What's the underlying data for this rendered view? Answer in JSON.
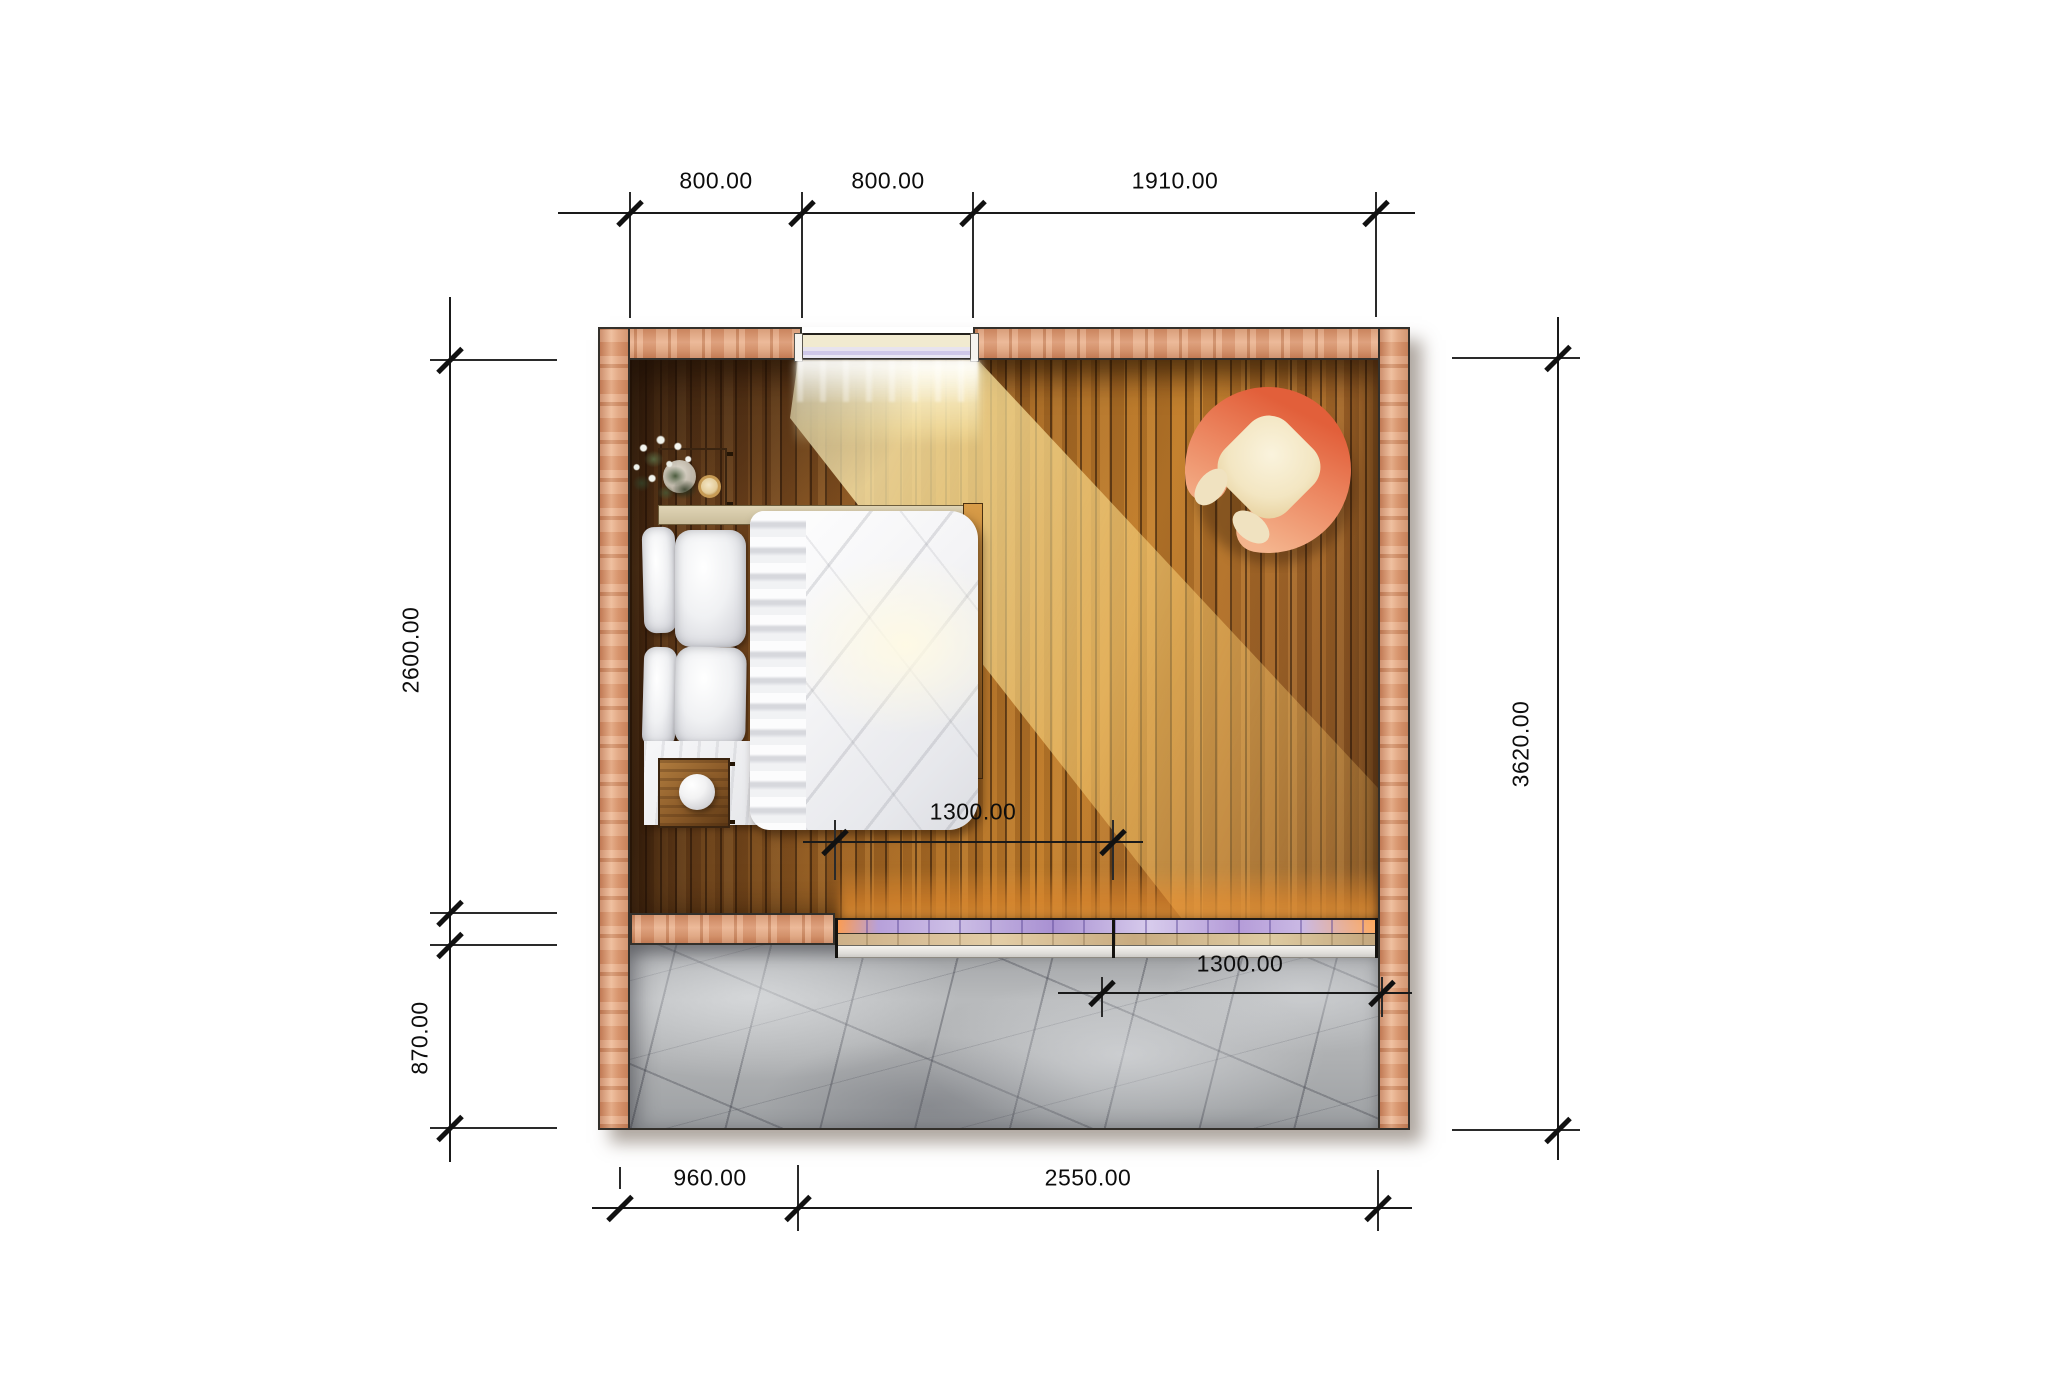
{
  "drawing": {
    "type": "architectural floor plan, top view render",
    "room": "bedroom with terrace",
    "items": [
      "bed",
      "pillows",
      "duvet",
      "nightstand",
      "flower-vase",
      "coffee-cup-coaster",
      "side-table",
      "sphere-lamp",
      "armchair",
      "window",
      "sliding-door-track",
      "wood-floor",
      "marble-terrace",
      "walls",
      "sunlight-streak"
    ]
  },
  "dimensions": {
    "top": [
      {
        "label": "800.00"
      },
      {
        "label": "800.00"
      },
      {
        "label": "1910.00"
      }
    ],
    "left": [
      {
        "label": "2600.00"
      },
      {
        "label": "870.00"
      }
    ],
    "right": [
      {
        "label": "3620.00"
      }
    ],
    "bottom": [
      {
        "label": "960.00"
      },
      {
        "label": "2550.00"
      }
    ],
    "interior": [
      {
        "label": "1300.00"
      },
      {
        "label": "1300.00"
      }
    ]
  },
  "colors": {
    "dim_line": "#1a1a1a",
    "wall_wood": "#dd9a76",
    "floor_dark": "#6b4423",
    "floor_light": "#c07d2b",
    "sunlight": "#ffe9a8",
    "marble": "#b4b6b8",
    "door_glass": "#b49ad8",
    "door_sill": "#f4f2ee",
    "armchair_back": "#e8764f",
    "armchair_seat": "#f5ead0",
    "bedding": "#ffffff"
  }
}
